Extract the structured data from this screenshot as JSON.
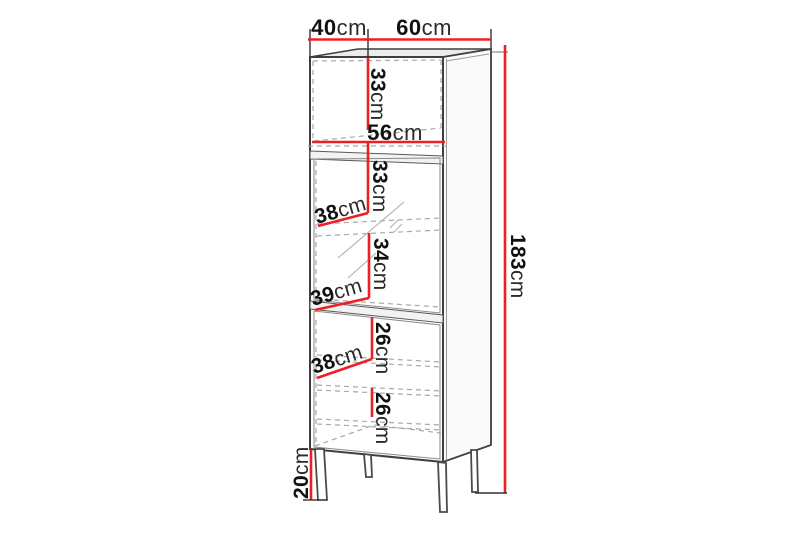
{
  "diagram": {
    "type": "furniture-dimension-drawing",
    "subject": "tall display cabinet with open niche, glass door section, lower door and metal legs",
    "colors": {
      "dimension_line": "#ec2024",
      "outline": "#3f3f3f",
      "hidden_edge": "#a8a8a8",
      "label_text": "#141414",
      "background": "#ffffff"
    },
    "dimensions": {
      "depth": {
        "value": "40",
        "unit": "cm"
      },
      "width": {
        "value": "60",
        "unit": "cm"
      },
      "niche_height": {
        "value": "33",
        "unit": "cm"
      },
      "niche_width": {
        "value": "56",
        "unit": "cm"
      },
      "glass_upper_height": {
        "value": "33",
        "unit": "cm"
      },
      "glass_shelf_depth": {
        "value": "38",
        "unit": "cm"
      },
      "glass_lower_height": {
        "value": "34",
        "unit": "cm"
      },
      "glass_bottom_depth": {
        "value": "39",
        "unit": "cm"
      },
      "lower_upper_height": {
        "value": "26",
        "unit": "cm"
      },
      "lower_shelf_depth": {
        "value": "38",
        "unit": "cm"
      },
      "lower_bottom_height": {
        "value": "26",
        "unit": "cm"
      },
      "total_height": {
        "value": "183",
        "unit": "cm"
      },
      "legs_height": {
        "value": "20",
        "unit": "cm"
      }
    }
  }
}
